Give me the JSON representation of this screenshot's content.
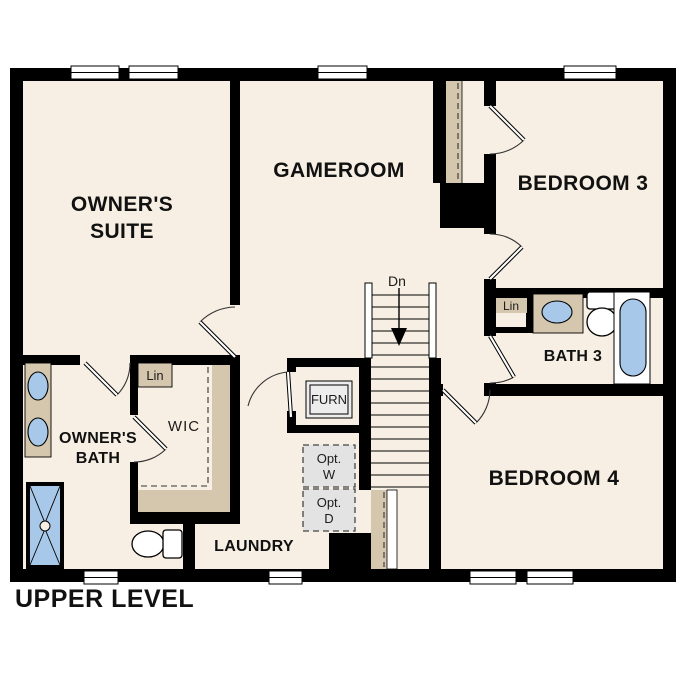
{
  "level_title": "UPPER LEVEL",
  "rooms": {
    "owners_suite": {
      "line1": "OWNER'S",
      "line2": "SUITE"
    },
    "gameroom": "GAMEROOM",
    "bedroom3": "BEDROOM 3",
    "bath3": "BATH 3",
    "bedroom4": "BEDROOM 4",
    "owners_bath": {
      "line1": "OWNER'S",
      "line2": "BATH"
    },
    "wic": "WIC",
    "laundry": "LAUNDRY"
  },
  "annotations": {
    "stair_direction": "Dn",
    "furnace": "FURN",
    "wic_linen": "Lin",
    "bath3_linen": "Lin",
    "optional_washer": {
      "line1": "Opt.",
      "line2": "W"
    },
    "optional_dryer": {
      "line1": "Opt.",
      "line2": "D"
    }
  },
  "colors": {
    "background": "#ffffff",
    "floor": "#f7efe3",
    "wall": "#000000",
    "casework_tan": "#d5c7ae",
    "fixture_blue": "#a7c8e8",
    "optional_appliance_gray": "#e3e3e3"
  }
}
